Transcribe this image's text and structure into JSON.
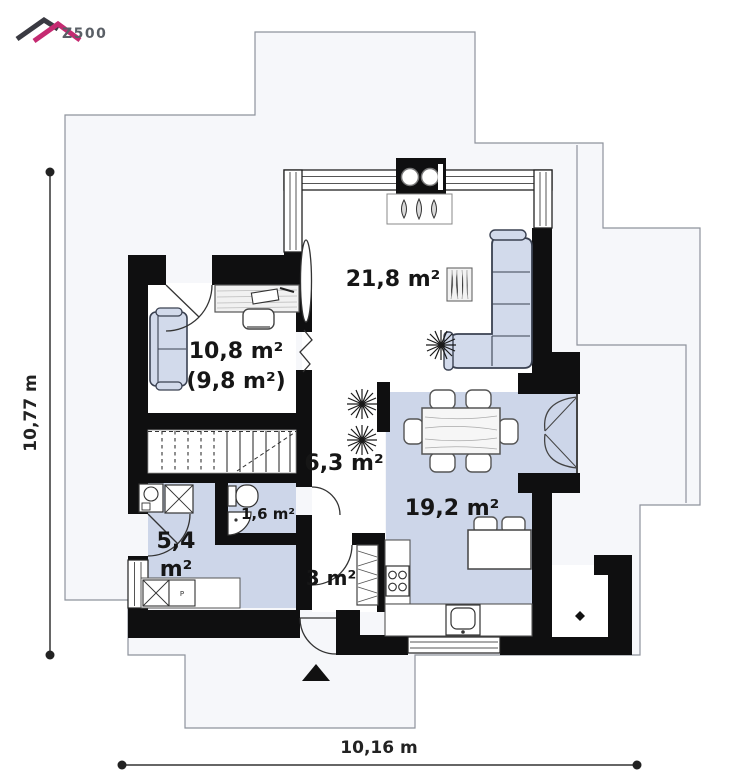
{
  "logo": {
    "brand": "Z500"
  },
  "plan": {
    "labels": {
      "living": "21,8 m²",
      "office": "10,8 m²",
      "office_alt": "(9,8 m²)",
      "hall": "6,3 m²",
      "dining": "19,2 m²",
      "wc": "1,6 m²",
      "utility_value": "5,4",
      "utility_unit": "m²",
      "entry": "3 m²"
    },
    "appliances": {
      "dryer": "P"
    },
    "dimensions": {
      "left": "10,77 m",
      "bottom": "10,16 m"
    },
    "colors": {
      "wall": "#0f0f10",
      "floor_blue": "#cdd6e9",
      "furniture_blue": "#d2daeb",
      "roof_outline_fill": "#f6f7fa",
      "roof_outline_stroke": "#8e939c",
      "logo_magenta": "#c52a71",
      "logo_dark": "#3a3a42"
    }
  }
}
